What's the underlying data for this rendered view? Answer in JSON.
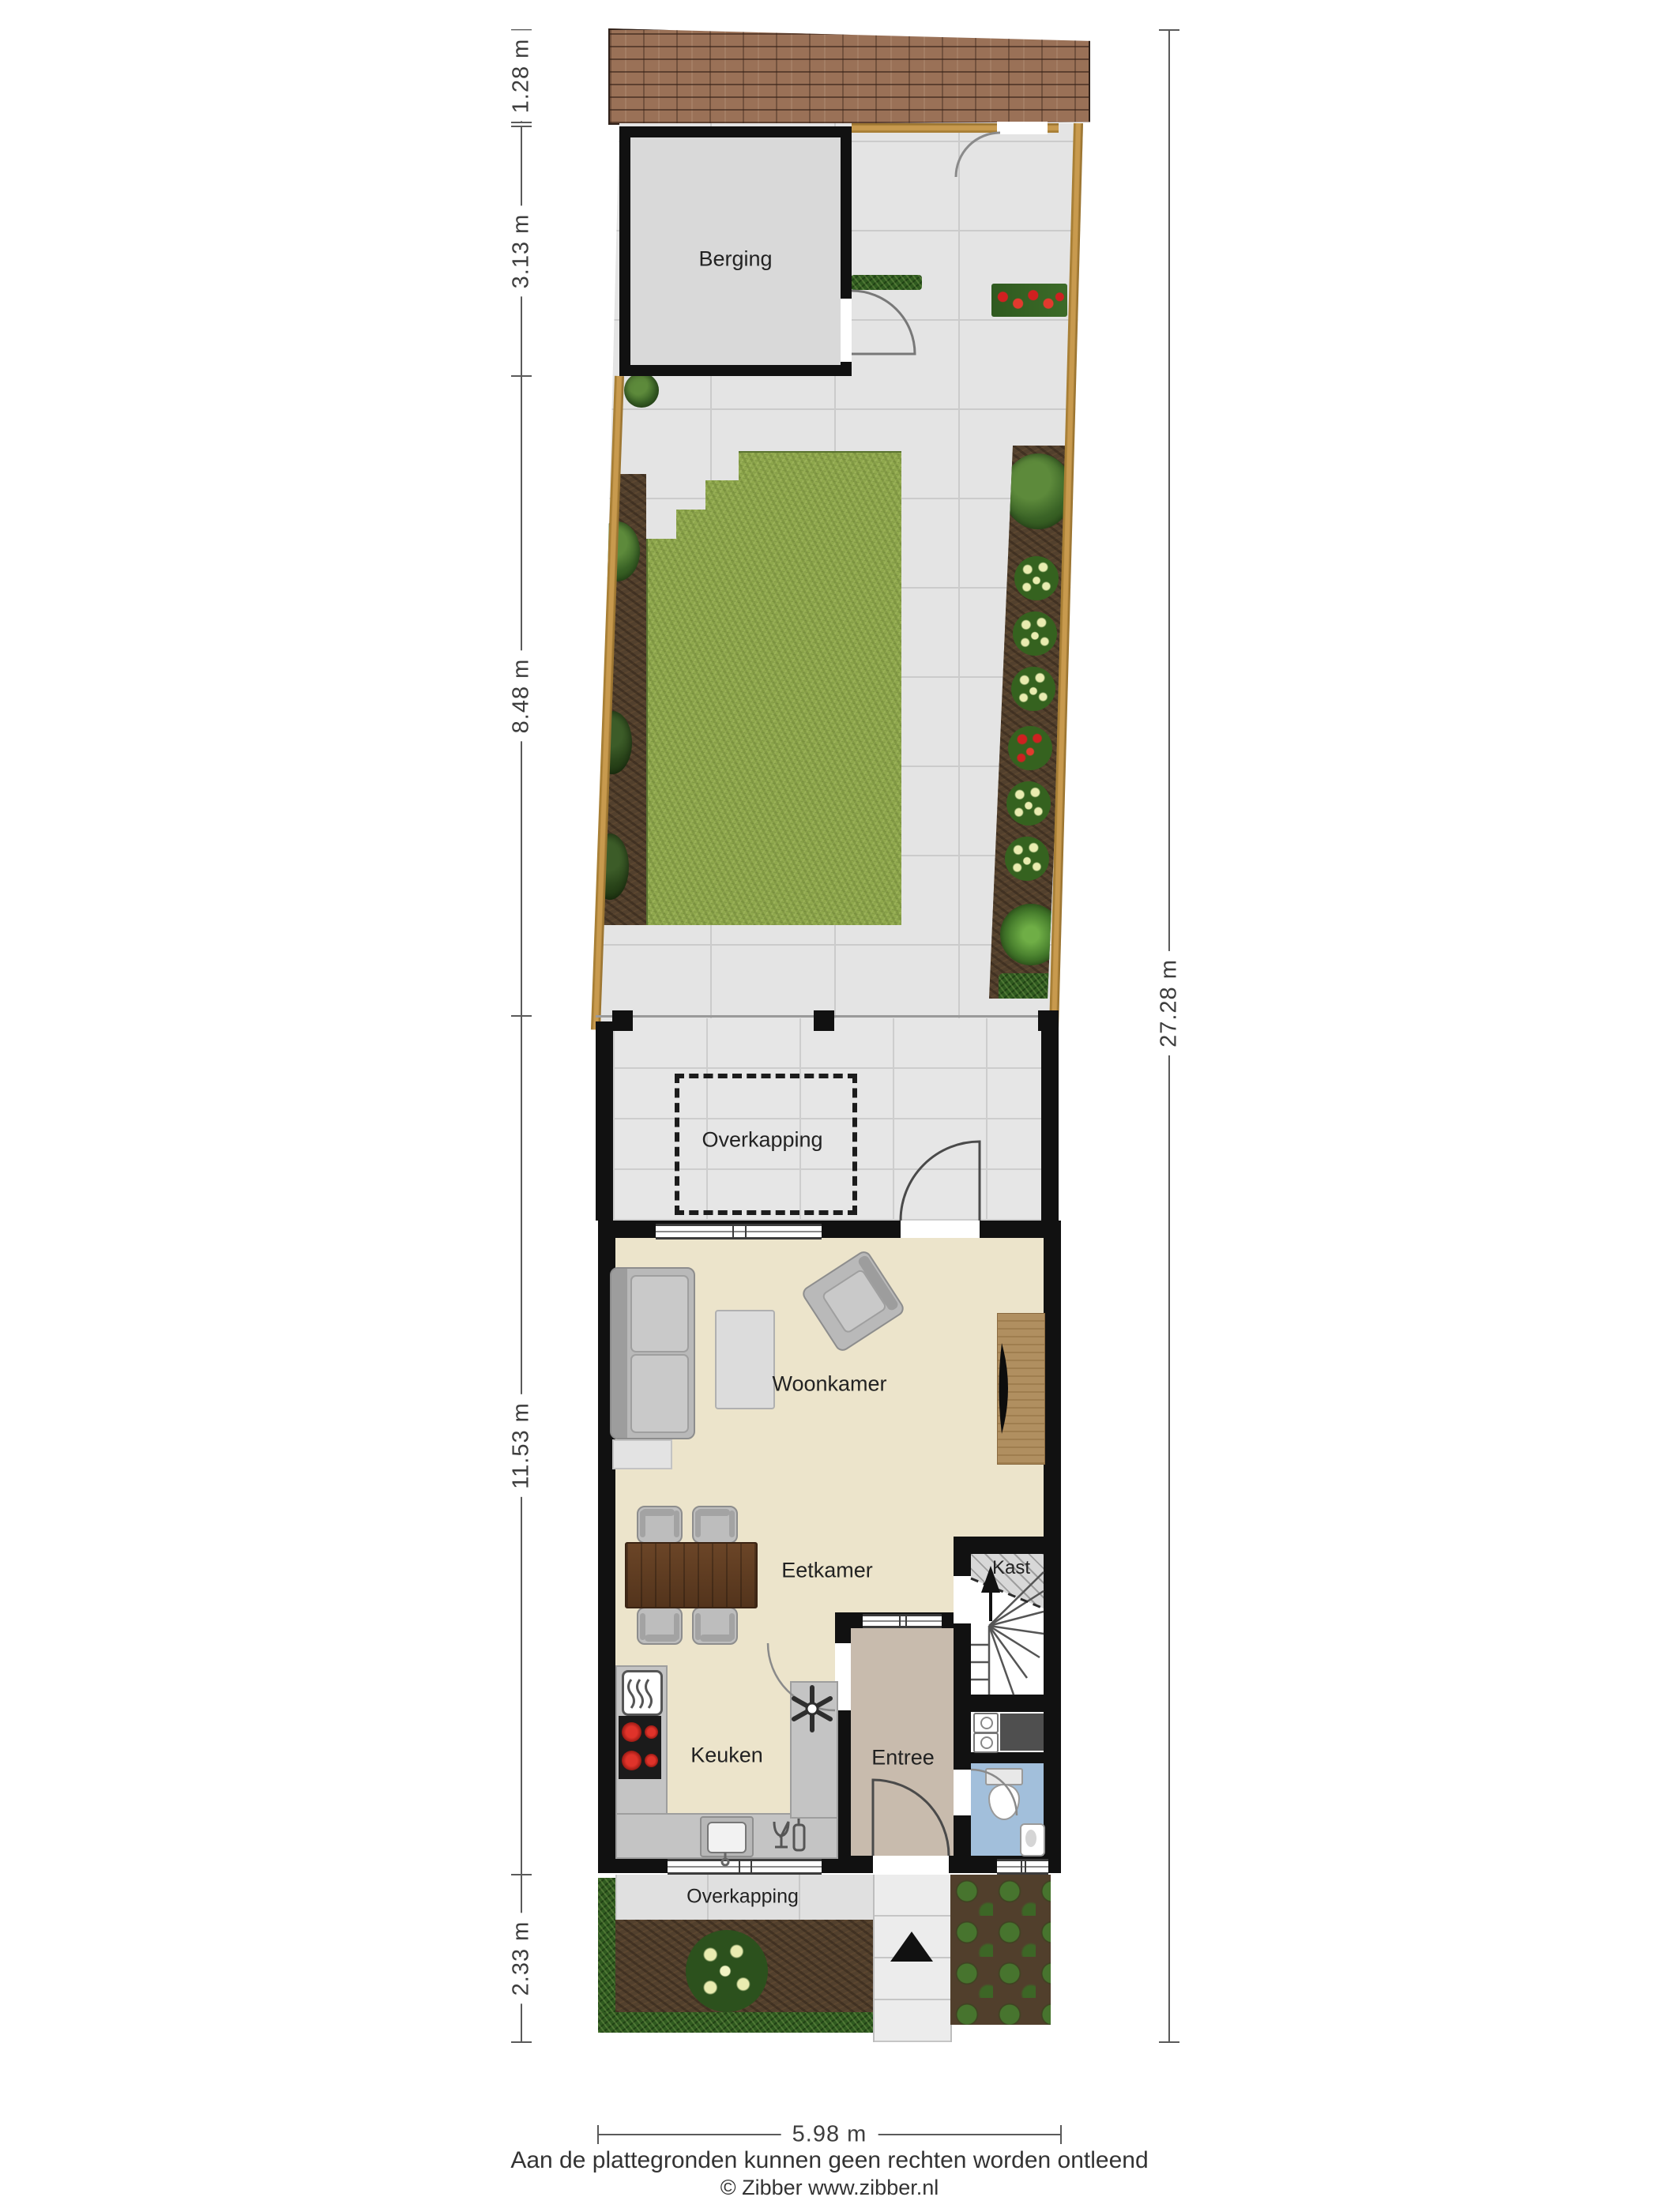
{
  "plan": {
    "rooms": {
      "berging": "Berging",
      "overkapping_rear": "Overkapping",
      "woonkamer": "Woonkamer",
      "eetkamer": "Eetkamer",
      "kast": "Kast",
      "keuken": "Keuken",
      "entree": "Entree",
      "overkapping_front": "Overkapping"
    },
    "dimensions": {
      "roof_depth": "1.28 m",
      "berging_depth": "3.13 m",
      "garden_depth": "8.48 m",
      "house_depth": "11.53 m",
      "front_garden_depth": "2.33 m",
      "total_depth": "27.28 m",
      "plot_width": "5.98 m"
    },
    "footer": {
      "disclaimer": "Aan de plattegronden kunnen geen rechten worden ontleend",
      "copyright": "© Zibber www.zibber.nl"
    },
    "colors": {
      "wall": "#111111",
      "floor_main": "#ece4cb",
      "floor_entree": "#c8bbad",
      "floor_toilet": "#a2bfdb",
      "floor_berging": "#d9d9d9",
      "lawn": "#8fa84d",
      "soil": "#52402d",
      "hedge": "#2f5a1f",
      "fence": "#c89a4e",
      "roof_brick": "#9a7157",
      "paving": "#e4e4e4",
      "accent_red": "#cf2020"
    }
  }
}
